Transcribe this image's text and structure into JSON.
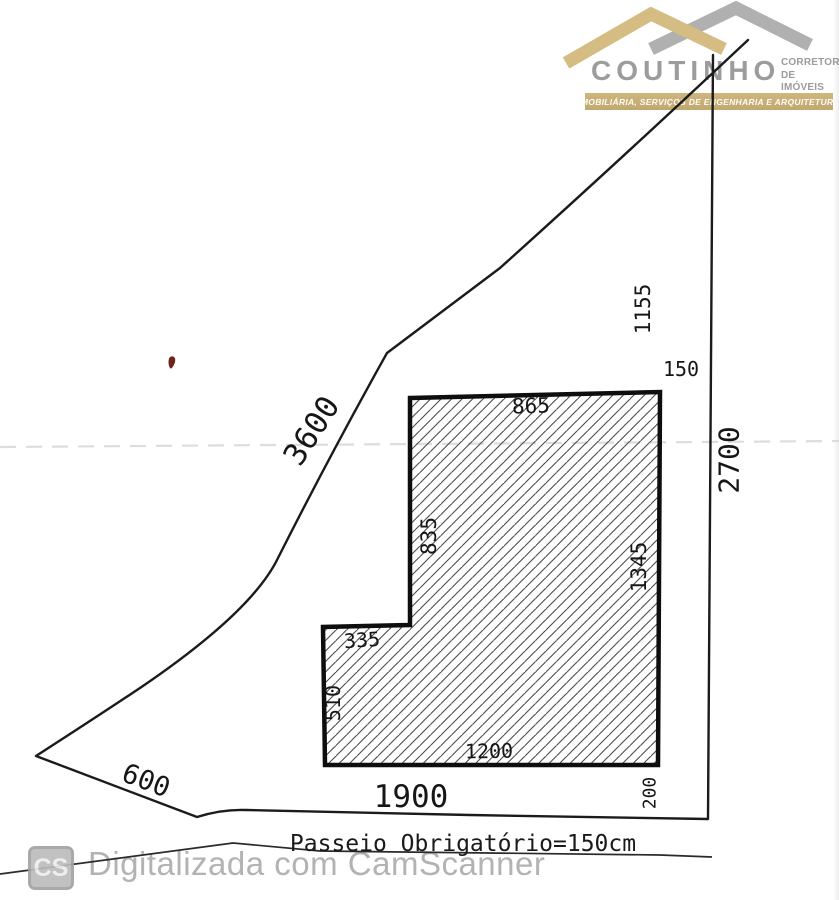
{
  "logo": {
    "brand": "COUTINHO",
    "subtitle_line1": "CORRETOR",
    "subtitle_line2": "DE IMÓVEIS",
    "banner": "IMOBILIÁRIA, SERVIÇOS DE ENGENHARIA E ARQUITETURA",
    "colors": {
      "gold": "#d5bc82",
      "gray": "#b0b0b0"
    }
  },
  "plan": {
    "dimensions": [
      {
        "name": "left-upper-boundary",
        "value": "3600"
      },
      {
        "name": "upper-setback",
        "value": "1155"
      },
      {
        "name": "right-setback",
        "value": "150"
      },
      {
        "name": "building-top",
        "value": "865"
      },
      {
        "name": "building-left-upper",
        "value": "835"
      },
      {
        "name": "building-right",
        "value": "1345"
      },
      {
        "name": "right-boundary",
        "value": "2700"
      },
      {
        "name": "building-step",
        "value": "335"
      },
      {
        "name": "building-left-lower",
        "value": "510"
      },
      {
        "name": "building-bottom",
        "value": "1200"
      },
      {
        "name": "lot-frontage",
        "value": "1900"
      },
      {
        "name": "rear-offset",
        "value": "200"
      },
      {
        "name": "left-lower-boundary",
        "value": "600"
      }
    ],
    "sidewalk_note": "Passeio Obrigatório=150cm"
  },
  "scanner": {
    "badge": "CS",
    "watermark": "Digitalizada com CamScanner"
  }
}
